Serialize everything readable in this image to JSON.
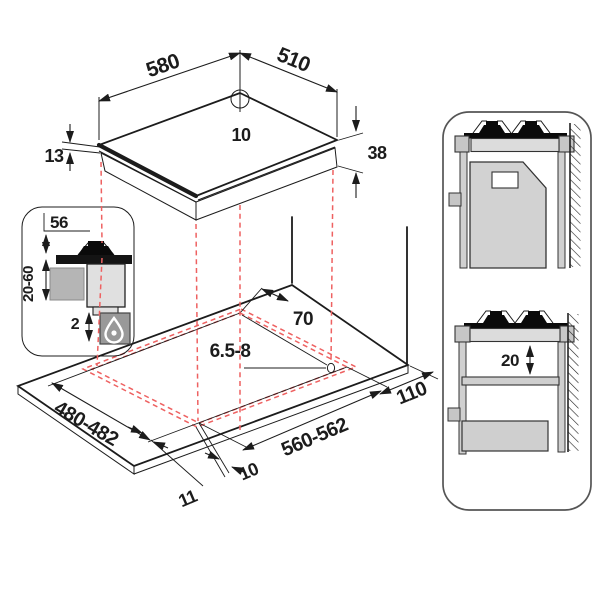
{
  "title": "Hob installation diagram",
  "labels": {
    "hob_width": "580",
    "hob_depth": "510",
    "hob_hole_diameter": "10",
    "hob_edge_thickness": "13",
    "hob_body_height": "38",
    "burner_height": "56",
    "worktop_thickness_range": "20-60",
    "clearance_below_worktop": "2",
    "hole_offset": "70",
    "hole_diameter_range": "6.5-8",
    "cutout_depth_range": "480-482",
    "cutout_width_range": "560-562",
    "rear_clearance": "110",
    "overhang_front": "10",
    "overhang_side": "11",
    "shelf_clearance": "20"
  },
  "colors": {
    "line": "#1c1c1c",
    "projection_red": "#ee6161",
    "fill_light": "#dcdcdc",
    "fill_mid": "#c6c6c6",
    "fill_dark": "#141414"
  }
}
